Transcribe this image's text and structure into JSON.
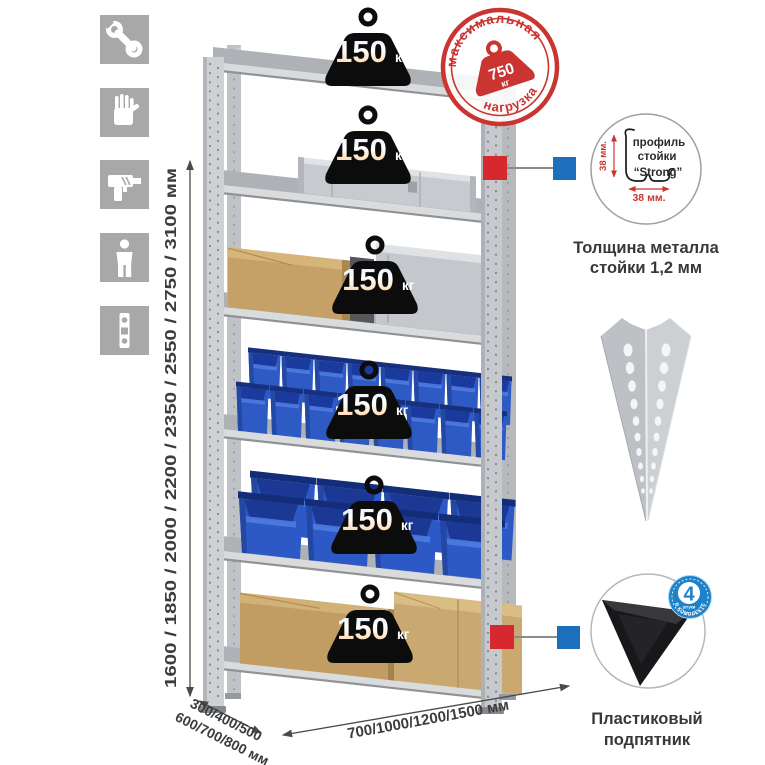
{
  "sidebar_icons": {
    "icon1": "wrench",
    "icon2": "gloves",
    "icon3": "drill",
    "icon4": "person",
    "icon5": "level"
  },
  "dimensions": {
    "height": "1600 / 1850 / 2000 / 2200 / 2350 / 2550 / 2750 / 3100 мм",
    "depth_line1": "300/400/500",
    "depth_line2": "600/700/800 мм",
    "width": "700/1000/1200/1500 мм"
  },
  "max_load_stamp": {
    "arc_top": "максимальная",
    "arc_bottom": "нагрузка",
    "value": "750",
    "unit": "кг"
  },
  "shelf_badge": {
    "value": "150",
    "unit": "кг",
    "count": 6
  },
  "profile_callout": {
    "text_line1": "профиль",
    "text_line2": "стойки",
    "text_line3": "“Strong”",
    "dim_vertical": "38 мм.",
    "dim_horizontal": "38 мм.",
    "caption_line1": "Толщина металла",
    "caption_line2": "стойки 1,2 мм"
  },
  "foot_callout": {
    "badge_number": "4",
    "badge_units": "штуки",
    "badge_arc": "в комплекте",
    "caption_line1": "Пластиковый",
    "caption_line2": "подпятник"
  },
  "colors": {
    "stamp_red": "#cb3531",
    "connector_red": "#d7282f",
    "connector_blue": "#1c6fba",
    "bin_blue": "#2e5ac4",
    "icon_bg": "#a8a8a8"
  }
}
